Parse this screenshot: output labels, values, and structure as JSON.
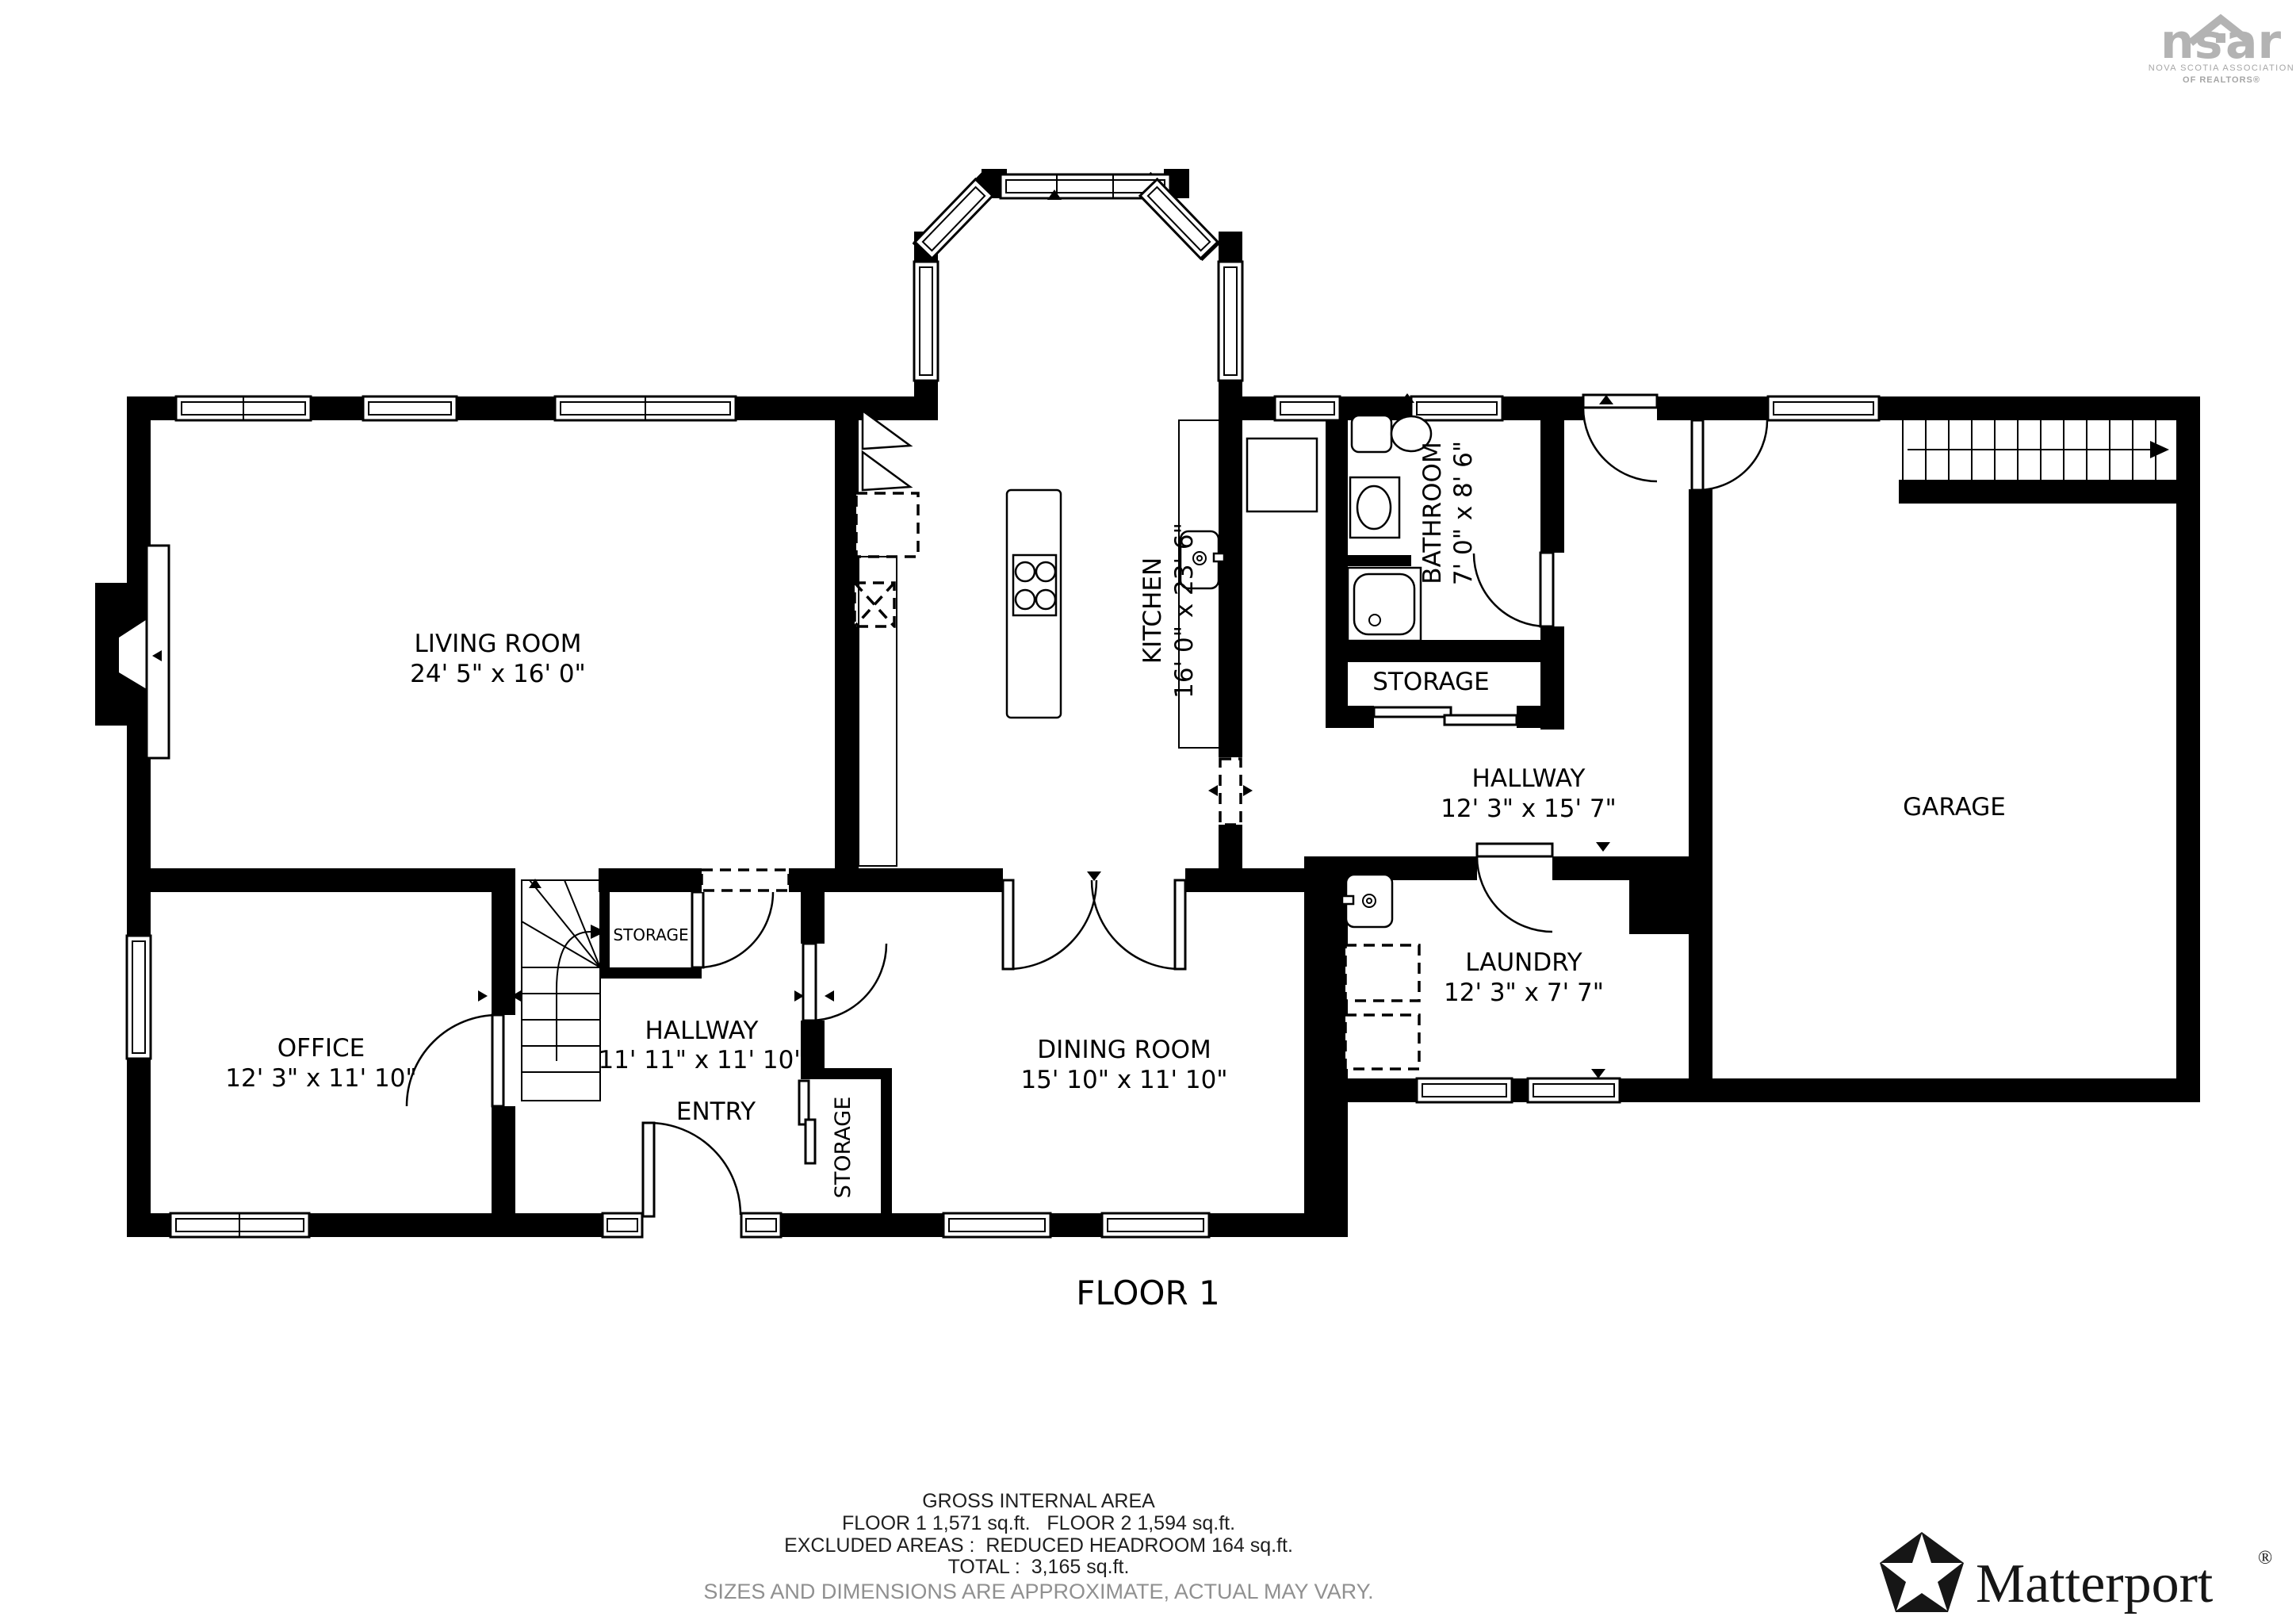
{
  "branding": {
    "nsar": {
      "left": "ns",
      "right": "ar",
      "line1": "NOVA SCOTIA ASSOCIATION",
      "line2": "OF REALTORS®",
      "color": "#b3b3b3"
    },
    "matterport": {
      "wordmark": "Matterport",
      "registered": "®"
    }
  },
  "floorplan": {
    "title": "FLOOR 1",
    "rooms": [
      {
        "id": "living-room",
        "name": "LIVING ROOM",
        "dims": "24' 5\" x 16' 0\""
      },
      {
        "id": "kitchen",
        "name": "KITCHEN",
        "dims": "16' 0\" x 23' 6\""
      },
      {
        "id": "bathroom",
        "name": "BATHROOM",
        "dims": "7' 0\" x 8' 6\""
      },
      {
        "id": "storage-back",
        "name": "STORAGE",
        "dims": ""
      },
      {
        "id": "hallway-back",
        "name": "HALLWAY",
        "dims": "12' 3\" x 15' 7\""
      },
      {
        "id": "garage",
        "name": "GARAGE",
        "dims": ""
      },
      {
        "id": "laundry",
        "name": "LAUNDRY",
        "dims": "12' 3\" x 7' 7\""
      },
      {
        "id": "office",
        "name": "OFFICE",
        "dims": "12' 3\" x 11' 10\""
      },
      {
        "id": "hallway-entry",
        "name": "HALLWAY",
        "dims": "11' 11\" x 11' 10\""
      },
      {
        "id": "entry",
        "name": "ENTRY",
        "dims": ""
      },
      {
        "id": "dining-room",
        "name": "DINING ROOM",
        "dims": "15' 10\" x 11' 10\""
      },
      {
        "id": "storage-hall",
        "name": "STORAGE",
        "dims": ""
      },
      {
        "id": "storage-entry",
        "name": "STORAGE",
        "dims": ""
      }
    ]
  },
  "footer": {
    "line1": "GROSS INTERNAL AREA",
    "line2": "FLOOR 1 1,571 sq.ft.   FLOOR 2 1,594 sq.ft.",
    "line3": "EXCLUDED AREAS :  REDUCED HEADROOM 164 sq.ft.",
    "line4": "TOTAL :  3,165 sq.ft.",
    "disclaimer": "SIZES AND DIMENSIONS ARE APPROXIMATE, ACTUAL MAY VARY."
  }
}
